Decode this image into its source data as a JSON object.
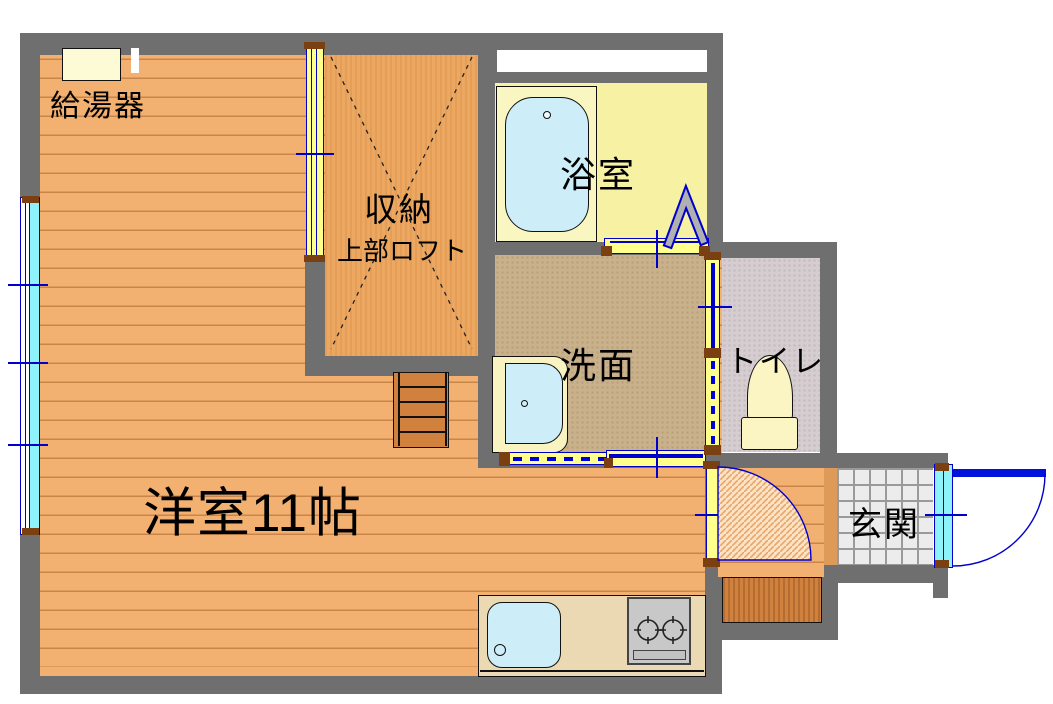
{
  "plan_title": "apartment-floor-plan",
  "rooms": {
    "main_room": {
      "label": "洋室11帖"
    },
    "storage": {
      "label": "収納",
      "sublabel": "上部ロフト"
    },
    "bathroom": {
      "label": "浴室"
    },
    "washroom": {
      "label": "洗面"
    },
    "toilet": {
      "label": "トイレ"
    },
    "entrance": {
      "label": "玄関"
    },
    "water_heater": {
      "label": "給湯器"
    }
  },
  "palette": {
    "wall_gray": "#6f6f6f",
    "wood_floor": "#f2b170",
    "plank_line": "#c9854a",
    "storage_floor": "#eca860",
    "bath_floor": "#f6f1a3",
    "wash_floor": "#c9b18c",
    "toilet_floor": "#d6cdd1",
    "tile_floor": "#ececec",
    "fixture_cream": "#faf5c2",
    "door_yellow": "#ffff8c",
    "water_blue": "#cdeef8",
    "symbol_blue": "#0000cc",
    "glass_cyan": "#8ef2fa",
    "step_wood": "#d0813d"
  }
}
